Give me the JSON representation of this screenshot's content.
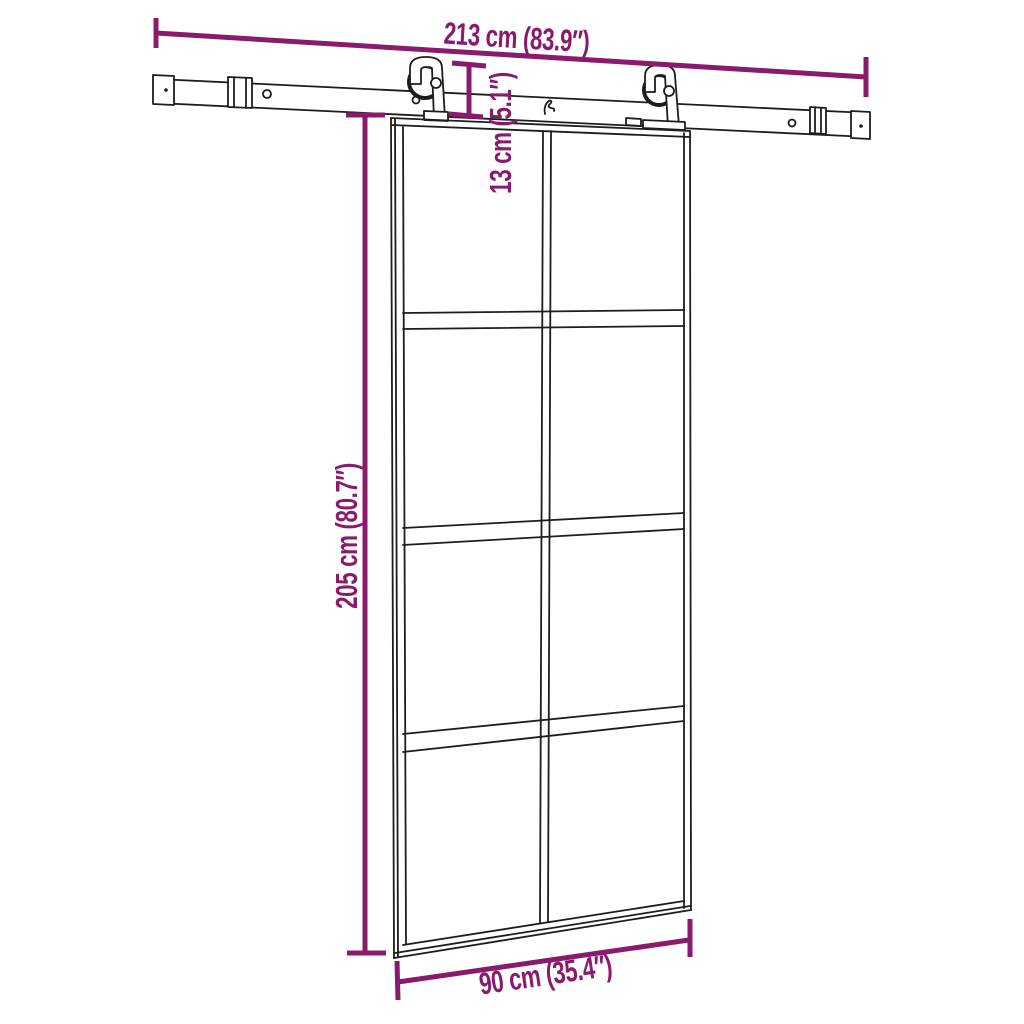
{
  "diagram": {
    "subject": "sliding-door-with-hardware-kit-dimension-drawing"
  },
  "dimensions": {
    "rail_length": {
      "label": "213 cm (83.9″)"
    },
    "rail_to_door_gap": {
      "label": "13 cm (5.1″)"
    },
    "door_height": {
      "label": "205 cm (80.7″)"
    },
    "door_width": {
      "label": "90 cm (35.4″)"
    }
  },
  "colors": {
    "annotation": "#8A1A6C",
    "drawing": "#1D1D1B",
    "background": "#FFFFFF"
  }
}
